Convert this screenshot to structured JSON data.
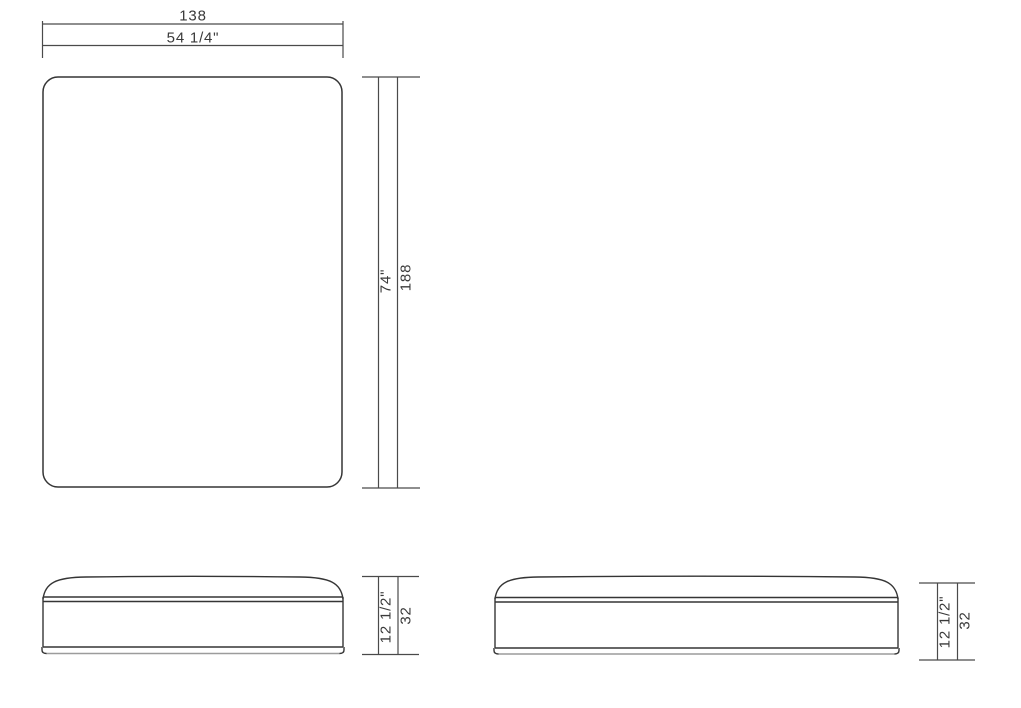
{
  "document": {
    "background": "#ffffff",
    "line_color": "#353535",
    "dimension_line_color": "#4a4a4a",
    "base_trim_color": "#9c9c9c"
  },
  "top_view": {
    "width": {
      "metric": "138",
      "imperial": "54 1/4\""
    },
    "length": {
      "imperial": "74\"",
      "metric": "188"
    }
  },
  "front_view": {
    "height": {
      "imperial": "12 1/2\"",
      "metric": "32"
    }
  },
  "side_view": {
    "height": {
      "imperial": "12 1/2\"",
      "metric": "32"
    }
  }
}
